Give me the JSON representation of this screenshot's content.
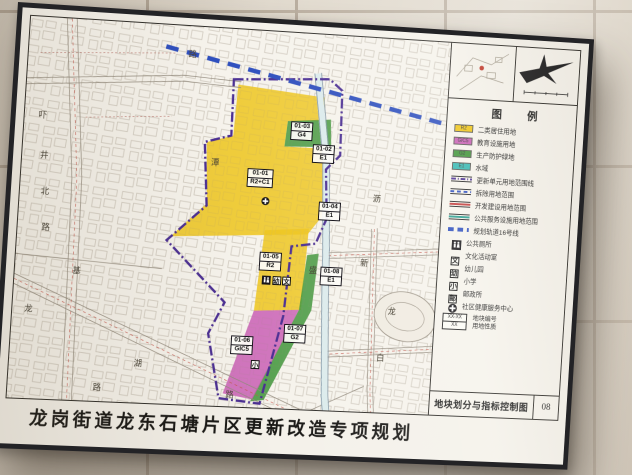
{
  "board": {
    "title": "龙岗街道龙东石塘片区更新改造专项规划",
    "sheet_name": "地块划分与指标控制图",
    "sheet_no": "08"
  },
  "legend": {
    "header": "图  例",
    "zones": [
      {
        "code": "R2",
        "label": "二类居住用地",
        "color": "#f0c619"
      },
      {
        "code": "GIC5",
        "label": "教育设施用地",
        "color": "#c95fb5"
      },
      {
        "code": "G2",
        "label": "生产防护绿地",
        "color": "#3f9438"
      },
      {
        "code": "E1",
        "label": "水域",
        "color": "#35b8b2"
      }
    ],
    "lines": [
      {
        "label": "更新单元用地范围线",
        "color": "#4b2f93",
        "style": "dashdot"
      },
      {
        "label": "拆除用地范围",
        "color": "#2e4fbe",
        "style": "dashed"
      },
      {
        "label": "开发建设用地范围",
        "color": "#c23b3b",
        "style": "solid"
      },
      {
        "label": "公共服务设施用地范围",
        "color": "#2a9d8f",
        "style": "solid"
      },
      {
        "label": "规划轨道16号线",
        "color": "#2e4fbe",
        "style": "bold-dashed"
      }
    ],
    "icons": [
      {
        "name": "public-toilet",
        "label": "公共厕所"
      },
      {
        "name": "culture-room",
        "glyph": "文",
        "label": "文化活动室"
      },
      {
        "name": "kindergarten",
        "glyph": "幼",
        "label": "幼儿园"
      },
      {
        "name": "primary-school",
        "glyph": "小",
        "label": "小学"
      },
      {
        "name": "post-office",
        "glyph": "邮",
        "label": "邮政所"
      },
      {
        "name": "health-center",
        "label": "社区健康服务中心"
      }
    ],
    "plot_note": {
      "sample_top": "XX-XX",
      "sample_bottom": "XX",
      "label_line1": "地块编号",
      "label_line2": "用地性质"
    }
  },
  "map": {
    "plots": [
      {
        "id": "01-01",
        "code": "R2+C1"
      },
      {
        "id": "01-02",
        "code": "E1"
      },
      {
        "id": "01-03",
        "code": "G4"
      },
      {
        "id": "01-04",
        "code": "E1"
      },
      {
        "id": "01-05",
        "code": "R2"
      },
      {
        "id": "01-06",
        "code": "GIC5"
      },
      {
        "id": "01-07",
        "code": "G2"
      },
      {
        "id": "01-08",
        "code": "E1"
      }
    ],
    "road_labels": [
      "路",
      "吓",
      "井",
      "北",
      "路",
      "基",
      "龙",
      "湖",
      "路",
      "潭",
      "沥",
      "新",
      "盛",
      "龙",
      "白",
      "路"
    ]
  },
  "colors": {
    "wall": "#d5ccc0",
    "paper": "#f4f1ea",
    "frame": "#232326",
    "residential_yellow": "#edc51d",
    "education_pink": "#c95fb5",
    "green": "#3f9438",
    "water_cyan": "#35b8b2",
    "boundary_purple": "#4b2f93",
    "rail_blue": "#2e4fbe",
    "road_red": "#c4544a"
  }
}
